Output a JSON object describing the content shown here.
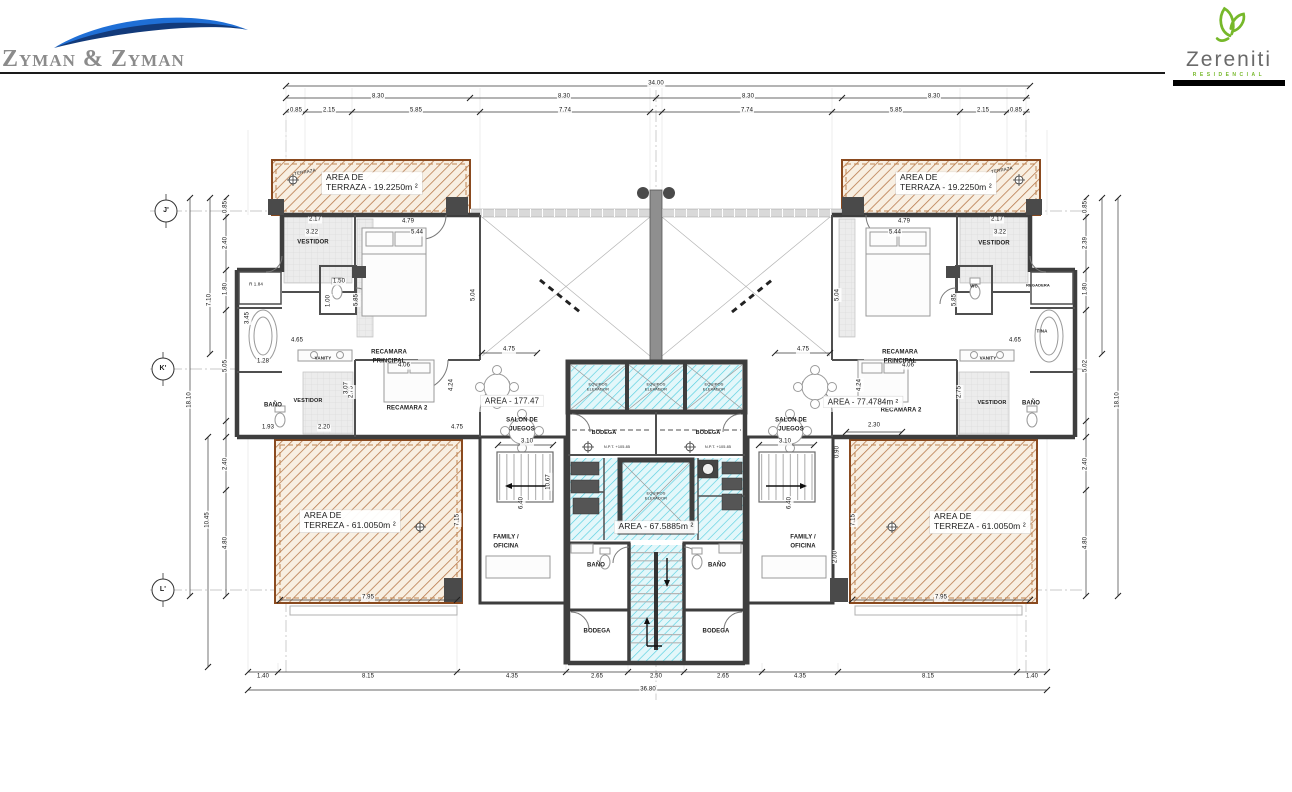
{
  "header": {
    "firm_name": "Zyman & Zyman",
    "brand_name": "Zereniti",
    "brand_subtitle": "RESIDENCIAL"
  },
  "colors": {
    "terrace_hatch": "#b97c4e",
    "terrace_border": "#8a4a1f",
    "core_hatch": "#55cfe0",
    "wall": "#3e3e3e",
    "logo_blue": "#1f6fd6",
    "logo_navy": "#123a7a",
    "logo_green": "#76b82a"
  },
  "plan": {
    "labels": [
      {
        "t": "34.00",
        "x": 656,
        "y": 84,
        "d": 1
      },
      {
        "t": "8.30",
        "x": 378,
        "y": 97,
        "d": 1
      },
      {
        "t": "8.30",
        "x": 564,
        "y": 97,
        "d": 1
      },
      {
        "t": "8.30",
        "x": 748,
        "y": 97,
        "d": 1
      },
      {
        "t": "8.30",
        "x": 934,
        "y": 97,
        "d": 1
      },
      {
        "t": "0.85",
        "x": 296,
        "y": 111,
        "d": 1
      },
      {
        "t": "2.15",
        "x": 329,
        "y": 111,
        "d": 1
      },
      {
        "t": "5.85",
        "x": 416,
        "y": 111,
        "d": 1
      },
      {
        "t": "7.74",
        "x": 565,
        "y": 111,
        "d": 1
      },
      {
        "t": "7.74",
        "x": 747,
        "y": 111,
        "d": 1
      },
      {
        "t": "5.85",
        "x": 896,
        "y": 111,
        "d": 1
      },
      {
        "t": "2.15",
        "x": 983,
        "y": 111,
        "d": 1
      },
      {
        "t": "0.85",
        "x": 1016,
        "y": 111,
        "d": 1
      },
      {
        "t": "0.85",
        "x": 226,
        "y": 207,
        "r": -90,
        "d": 1
      },
      {
        "t": "2.40",
        "x": 226,
        "y": 243,
        "r": -90,
        "d": 1
      },
      {
        "t": "1.80",
        "x": 226,
        "y": 289,
        "r": -90,
        "d": 1
      },
      {
        "t": "5.05",
        "x": 226,
        "y": 366,
        "r": -90,
        "d": 1
      },
      {
        "t": "7.10",
        "x": 210,
        "y": 300,
        "r": -90,
        "d": 1
      },
      {
        "t": "18.10",
        "x": 190,
        "y": 400,
        "r": -90,
        "d": 1
      },
      {
        "t": "2.40",
        "x": 226,
        "y": 464,
        "r": -90,
        "d": 1
      },
      {
        "t": "4.80",
        "x": 226,
        "y": 543,
        "r": -90,
        "d": 1
      },
      {
        "t": "10.45",
        "x": 208,
        "y": 520,
        "r": -90,
        "d": 1
      },
      {
        "t": "0.85",
        "x": 1086,
        "y": 207,
        "r": -90,
        "d": 1
      },
      {
        "t": "2.39",
        "x": 1086,
        "y": 243,
        "r": -90,
        "d": 1
      },
      {
        "t": "1.80",
        "x": 1086,
        "y": 289,
        "r": -90,
        "d": 1
      },
      {
        "t": "5.02",
        "x": 1086,
        "y": 366,
        "r": -90,
        "d": 1
      },
      {
        "t": "18.10",
        "x": 1118,
        "y": 400,
        "r": -90,
        "d": 1
      },
      {
        "t": "2.40",
        "x": 1086,
        "y": 464,
        "r": -90,
        "d": 1
      },
      {
        "t": "4.80",
        "x": 1086,
        "y": 543,
        "r": -90,
        "d": 1
      },
      {
        "t": "1.40",
        "x": 263,
        "y": 677,
        "d": 1
      },
      {
        "t": "8.15",
        "x": 368,
        "y": 677,
        "d": 1
      },
      {
        "t": "4.35",
        "x": 512,
        "y": 677,
        "d": 1
      },
      {
        "t": "2.65",
        "x": 597,
        "y": 677,
        "d": 1
      },
      {
        "t": "2.50",
        "x": 656,
        "y": 677,
        "d": 1
      },
      {
        "t": "2.65",
        "x": 723,
        "y": 677,
        "d": 1
      },
      {
        "t": "4.35",
        "x": 800,
        "y": 677,
        "d": 1
      },
      {
        "t": "8.15",
        "x": 928,
        "y": 677,
        "d": 1
      },
      {
        "t": "1.40",
        "x": 1032,
        "y": 677,
        "d": 1
      },
      {
        "t": "36.80",
        "x": 648,
        "y": 690,
        "d": 1
      },
      {
        "t": "7.95",
        "x": 368,
        "y": 598,
        "d": 1
      },
      {
        "t": "7.95",
        "x": 941,
        "y": 598,
        "d": 1
      },
      {
        "t": "2.17",
        "x": 315,
        "y": 220,
        "d": 1
      },
      {
        "t": "4.79",
        "x": 408,
        "y": 222,
        "d": 1
      },
      {
        "t": "3.22",
        "x": 312,
        "y": 233,
        "d": 1
      },
      {
        "t": "5.44",
        "x": 417,
        "y": 233,
        "d": 1
      },
      {
        "t": "2.17",
        "x": 997,
        "y": 220,
        "d": 1
      },
      {
        "t": "4.79",
        "x": 904,
        "y": 222,
        "d": 1
      },
      {
        "t": "3.22",
        "x": 1000,
        "y": 233,
        "d": 1
      },
      {
        "t": "5.44",
        "x": 895,
        "y": 233,
        "d": 1
      },
      {
        "t": "5.85",
        "x": 357,
        "y": 300,
        "r": -90,
        "d": 1
      },
      {
        "t": "5.04",
        "x": 474,
        "y": 295,
        "r": -90,
        "d": 1
      },
      {
        "t": "5.85",
        "x": 955,
        "y": 300,
        "r": -90,
        "d": 1
      },
      {
        "t": "5.04",
        "x": 838,
        "y": 295,
        "r": -90,
        "d": 1
      },
      {
        "t": "4.65",
        "x": 297,
        "y": 341,
        "d": 1
      },
      {
        "t": "4.65",
        "x": 1015,
        "y": 341,
        "d": 1
      },
      {
        "t": "2.75",
        "x": 352,
        "y": 392,
        "r": -90,
        "d": 1
      },
      {
        "t": "2.75",
        "x": 960,
        "y": 392,
        "r": -90,
        "d": 1
      },
      {
        "t": "1.50",
        "x": 339,
        "y": 282,
        "d": 1
      },
      {
        "t": "1.00",
        "x": 329,
        "y": 301,
        "r": -90,
        "d": 1
      },
      {
        "t": "1.28",
        "x": 263,
        "y": 362,
        "d": 1
      },
      {
        "t": "3.45",
        "x": 248,
        "y": 318,
        "r": -90,
        "d": 1
      },
      {
        "t": "R 1.84",
        "x": 256,
        "y": 284,
        "s": 4.5,
        "d": 1
      },
      {
        "t": "4.06",
        "x": 404,
        "y": 366,
        "d": 1
      },
      {
        "t": "4.06",
        "x": 908,
        "y": 366,
        "d": 1
      },
      {
        "t": "4.24",
        "x": 452,
        "y": 385,
        "r": -90,
        "d": 1
      },
      {
        "t": "4.24",
        "x": 860,
        "y": 385,
        "r": -90,
        "d": 1
      },
      {
        "t": "3.07",
        "x": 347,
        "y": 388,
        "r": -90,
        "d": 1
      },
      {
        "t": "1.93",
        "x": 268,
        "y": 428,
        "d": 1
      },
      {
        "t": "2.20",
        "x": 324,
        "y": 428,
        "d": 1
      },
      {
        "t": "4.75",
        "x": 457,
        "y": 428,
        "d": 1
      },
      {
        "t": "2.30",
        "x": 874,
        "y": 426,
        "d": 1
      },
      {
        "t": "4.75",
        "x": 509,
        "y": 350,
        "d": 1
      },
      {
        "t": "4.75",
        "x": 803,
        "y": 350,
        "d": 1
      },
      {
        "t": "3.10",
        "x": 527,
        "y": 442,
        "d": 1
      },
      {
        "t": "3.10",
        "x": 785,
        "y": 442,
        "d": 1
      },
      {
        "t": "10.67",
        "x": 549,
        "y": 482,
        "r": -90,
        "d": 1
      },
      {
        "t": "0.90",
        "x": 838,
        "y": 452,
        "r": -90,
        "d": 1
      },
      {
        "t": "2.00",
        "x": 836,
        "y": 557,
        "r": -90,
        "d": 1
      },
      {
        "t": "6.40",
        "x": 522,
        "y": 503,
        "r": -90,
        "d": 1
      },
      {
        "t": "6.40",
        "x": 790,
        "y": 503,
        "r": -90,
        "d": 1
      },
      {
        "t": "7.15",
        "x": 458,
        "y": 520,
        "r": -90,
        "d": 1
      },
      {
        "t": "7.15",
        "x": 854,
        "y": 520,
        "r": -90,
        "d": 1
      },
      {
        "t": "VESTIDOR",
        "x": 313,
        "y": 243,
        "b": 1
      },
      {
        "t": "RECAMARA",
        "x": 389,
        "y": 353,
        "b": 1
      },
      {
        "t": "PRINCIPAL",
        "x": 389,
        "y": 362,
        "b": 1
      },
      {
        "t": "RECAMARA",
        "x": 900,
        "y": 353,
        "b": 1
      },
      {
        "t": "PRINCIPAL",
        "x": 900,
        "y": 362,
        "b": 1
      },
      {
        "t": "VANITY",
        "x": 323,
        "y": 358,
        "s": 4.5,
        "b": 1
      },
      {
        "t": "VANITY",
        "x": 988,
        "y": 358,
        "s": 4.5,
        "b": 1
      },
      {
        "t": "BAÑO",
        "x": 273,
        "y": 406,
        "b": 1
      },
      {
        "t": "VESTIDOR",
        "x": 308,
        "y": 401,
        "b": 1,
        "s": 5.5
      },
      {
        "t": "RECAMARA 2",
        "x": 407,
        "y": 409,
        "b": 1
      },
      {
        "t": "RECAMARA 2",
        "x": 901,
        "y": 411,
        "b": 1
      },
      {
        "t": "VESTIDOR",
        "x": 992,
        "y": 403,
        "b": 1,
        "s": 5.5
      },
      {
        "t": "BAÑO",
        "x": 1031,
        "y": 404,
        "b": 1
      },
      {
        "t": "VESTIDOR",
        "x": 994,
        "y": 244,
        "b": 1
      },
      {
        "t": "WC",
        "x": 974,
        "y": 286,
        "b": 1,
        "s": 4.5
      },
      {
        "t": "REGADERA",
        "x": 1038,
        "y": 286,
        "b": 1,
        "s": 4
      },
      {
        "t": "TINA",
        "x": 1042,
        "y": 331,
        "b": 1,
        "s": 4.5
      },
      {
        "t": "SALON DE",
        "x": 522,
        "y": 421,
        "b": 1
      },
      {
        "t": "JUEGOS",
        "x": 522,
        "y": 430,
        "b": 1
      },
      {
        "t": "SALON DE",
        "x": 791,
        "y": 421,
        "b": 1
      },
      {
        "t": "JUEGOS",
        "x": 791,
        "y": 430,
        "b": 1
      },
      {
        "t": "FAMILY /",
        "x": 506,
        "y": 538,
        "b": 1
      },
      {
        "t": "OFICINA",
        "x": 506,
        "y": 547,
        "b": 1
      },
      {
        "t": "FAMILY /",
        "x": 803,
        "y": 538,
        "b": 1
      },
      {
        "t": "OFICINA",
        "x": 803,
        "y": 547,
        "b": 1
      },
      {
        "t": "BODEGA",
        "x": 604,
        "y": 433,
        "b": 1,
        "s": 5.5
      },
      {
        "t": "BODEGA",
        "x": 708,
        "y": 433,
        "b": 1,
        "s": 5.5
      },
      {
        "t": "N.P.T. +105.85",
        "x": 617,
        "y": 447,
        "s": 3.8
      },
      {
        "t": "N.P.T. +105.85",
        "x": 718,
        "y": 447,
        "s": 3.8
      },
      {
        "t": "BAÑO",
        "x": 596,
        "y": 566,
        "b": 1
      },
      {
        "t": "BAÑO",
        "x": 717,
        "y": 566,
        "b": 1
      },
      {
        "t": "BODEGA",
        "x": 597,
        "y": 632,
        "b": 1
      },
      {
        "t": "BODEGA",
        "x": 716,
        "y": 632,
        "b": 1
      },
      {
        "t": "EQUIPOS ELEVADOR",
        "x": 598,
        "y": 387,
        "s": 4,
        "w": 32
      },
      {
        "t": "EQUIPOS ELEVADOR",
        "x": 656,
        "y": 387,
        "s": 4,
        "w": 32
      },
      {
        "t": "EQUIPOS ELEVADOR",
        "x": 714,
        "y": 387,
        "s": 4,
        "w": 32
      },
      {
        "t": "EQUIPOS ELEVADOR",
        "x": 656,
        "y": 496,
        "s": 4,
        "w": 32
      },
      {
        "t": "AREA - 177.47",
        "x": 512,
        "y": 401,
        "s": 8,
        "bg": 1
      },
      {
        "t": "AREA - 77.4784m ²",
        "x": 863,
        "y": 402,
        "s": 8,
        "bg": 1
      },
      {
        "t": "AREA - 67.5885m ²",
        "x": 656,
        "y": 527,
        "s": 8.5,
        "bg": 1
      },
      {
        "t": "AREA DE\nTERRAZA - 19.2250m ²",
        "x": 322,
        "y": 183,
        "s": 8.5,
        "bg": 1,
        "a": 1
      },
      {
        "t": "AREA DE\nTERRAZA - 19.2250m ²",
        "x": 896,
        "y": 183,
        "s": 8.5,
        "bg": 1,
        "a": 1
      },
      {
        "t": "AREA DE\nTERREZA - 61.0050m ²",
        "x": 300,
        "y": 521,
        "s": 8.5,
        "bg": 1,
        "a": 1
      },
      {
        "t": "AREA DE\nTERREZA - 61.0050m ²",
        "x": 930,
        "y": 522,
        "s": 8.5,
        "bg": 1,
        "a": 1
      },
      {
        "t": "TERRAZA",
        "x": 305,
        "y": 172,
        "s": 4.5,
        "r": -10
      },
      {
        "t": "TERRAZA",
        "x": 1002,
        "y": 170,
        "s": 4.5,
        "r": -10
      },
      {
        "t": "J'",
        "x": 166,
        "y": 211,
        "s": 7,
        "b": 1,
        "n": "grid-marker-j"
      },
      {
        "t": "K'",
        "x": 163,
        "y": 369,
        "s": 7,
        "b": 1,
        "n": "grid-marker-k"
      },
      {
        "t": "L'",
        "x": 163,
        "y": 590,
        "s": 7,
        "b": 1,
        "n": "grid-marker-l"
      }
    ]
  }
}
